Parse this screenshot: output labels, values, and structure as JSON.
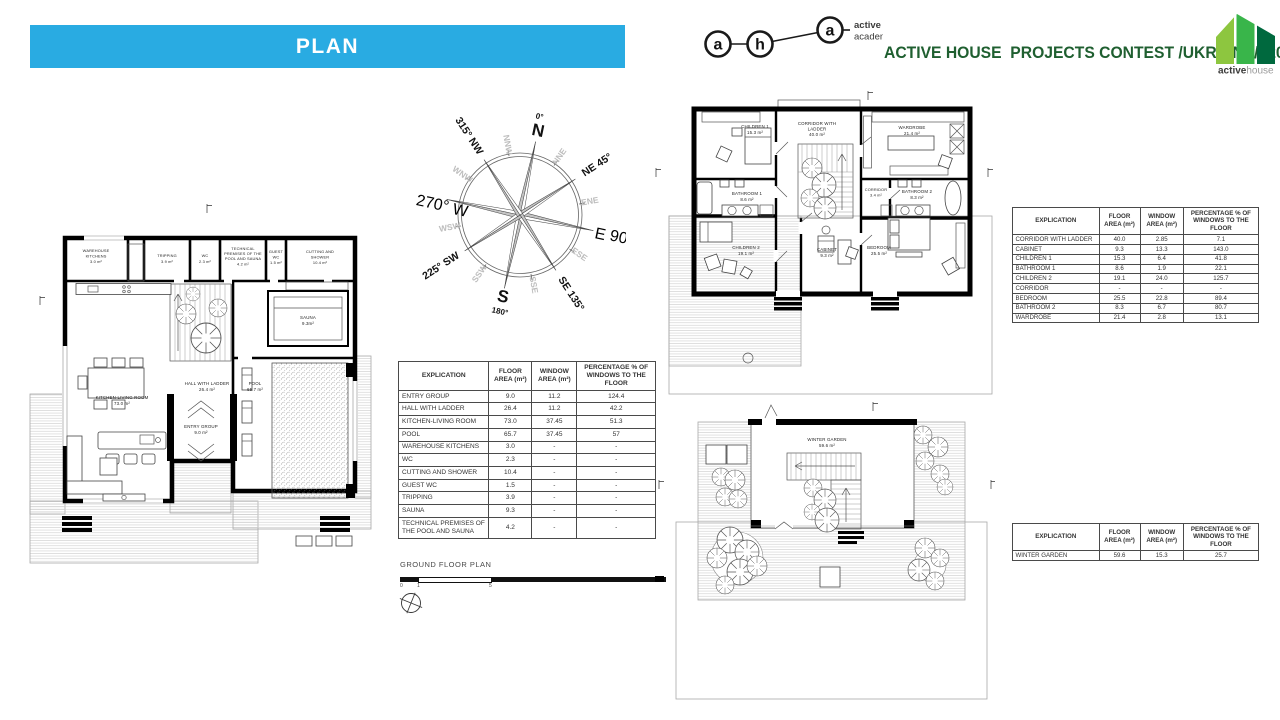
{
  "slide": {
    "section_title": "PLAN"
  },
  "branding": {
    "academy": {
      "letter1": "a",
      "letter2": "h",
      "letter3": "a",
      "line1": "active house",
      "line2": "academy"
    },
    "contest_title": "ACTIVE HOUSE  PROJECTS CONTEST /UKRAINE/  2019",
    "activehouse": {
      "bold": "active",
      "light": "house"
    },
    "colors": {
      "banner_blue": "#29ABE2",
      "title_green": "#1F5F30",
      "logo_light_green": "#8DC63F",
      "logo_mid_green": "#39B54A",
      "logo_dark_green": "#00693E"
    }
  },
  "compass": {
    "n": "N",
    "n_deg": "0°",
    "e": "E",
    "e_deg": " 90°",
    "s": "S",
    "s_deg": "180°",
    "w": "W",
    "w_deg": "270° ",
    "ne": "NE 45°",
    "se": "SE 135°",
    "sw": "225° SW",
    "nw": "315° NW",
    "secondary": [
      "NNE",
      "ENE",
      "ESE",
      "SSE",
      "SSW",
      "WSW",
      "WNW",
      "NNW"
    ]
  },
  "ground_floor": {
    "caption": "GROUND FLOOR PLAN",
    "scale": [
      "0",
      "1",
      "5"
    ],
    "rooms": {
      "warehouse": {
        "l1": "WAREHOUSE",
        "l2": "KITCHENS",
        "area": "3.0 m²"
      },
      "tripping": {
        "l1": "TRIPPING",
        "area": "3.9 m²"
      },
      "wc": {
        "l1": "WC",
        "area": "2.3 m²"
      },
      "technical": {
        "l1": "TECHNICAL",
        "l2": "PREMISES OF THE",
        "l3": "POOL AND SAUNA",
        "area": "4.2 m²"
      },
      "guest_wc": {
        "l1": "GUEST",
        "l2": "WC",
        "area": "1.5 m²"
      },
      "cutting": {
        "l1": "CUTTING AND",
        "l2": "SHOWER",
        "area": "10.4 m²"
      },
      "sauna": {
        "l1": "SAUNA",
        "area": "9.3m²"
      },
      "hall": {
        "l1": "HALL WITH LADDER",
        "area": "26.4 m²"
      },
      "pool": {
        "l1": "POOL",
        "area": "65.7 m²"
      },
      "entry": {
        "l1": "ENTRY GROUP",
        "area": "9.0 m²"
      },
      "kitchen": {
        "l1": "KITCHEN-LIVING ROOM",
        "area": "73.0 m²"
      }
    }
  },
  "first_floor": {
    "rooms": {
      "children1": {
        "l1": "CHILDREN 1",
        "area": "15.3 m²"
      },
      "corridor_ladder": {
        "l1": "CORRIDOR WITH",
        "l2": "LADDER",
        "area": "40.0 m²"
      },
      "wardrobe": {
        "l1": "WARDROBE",
        "area": "21.4 m²"
      },
      "bathroom1": {
        "l1": "BATHROOM 1",
        "area": "8.6 m²"
      },
      "corridor": {
        "l1": "CORRIDOR",
        "area": "3.4 m²"
      },
      "bathroom2": {
        "l1": "BATHROOM 2",
        "area": "8.3 m²"
      },
      "children2": {
        "l1": "CHILDREN 2",
        "area": "19.1 m²"
      },
      "cabinet": {
        "l1": "CABINET",
        "area": "9.3 m²"
      },
      "bedroom": {
        "l1": "BEDROOM",
        "area": "25.5 m²"
      }
    }
  },
  "winter_garden": {
    "rooms": {
      "winter_garden": {
        "l1": "WINTER GARDEN",
        "area": "59.6 m²"
      }
    }
  },
  "tables": {
    "ground": {
      "columns": [
        "EXPLICATION",
        "FLOOR\nAREA (m²)",
        "WINDOW\nAREA (m²)",
        "PERCENTAGE % OF\nWINDOWS TO THE FLOOR"
      ],
      "rows": [
        [
          "ENTRY GROUP",
          "9.0",
          "11.2",
          "124.4"
        ],
        [
          "HALL WITH LADDER",
          "26.4",
          "11.2",
          "42.2"
        ],
        [
          "KITCHEN-LIVING ROOM",
          "73.0",
          "37.45",
          "51.3"
        ],
        [
          "POOL",
          "65.7",
          "37.45",
          "57"
        ],
        [
          "WAREHOUSE KITCHENS",
          "3.0",
          "-",
          "-"
        ],
        [
          "WC",
          "2.3",
          "-",
          "-"
        ],
        [
          "CUTTING AND SHOWER",
          "10.4",
          "-",
          "-"
        ],
        [
          "GUEST WC",
          "1.5",
          "-",
          "-"
        ],
        [
          "TRIPPING",
          "3.9",
          "-",
          "-"
        ],
        [
          "SAUNA",
          "9.3",
          "-",
          "-"
        ],
        [
          "TECHNICAL PREMISES OF THE POOL AND SAUNA",
          "4.2",
          "-",
          "-"
        ]
      ]
    },
    "first": {
      "columns": [
        "EXPLICATION",
        "FLOOR\nAREA (m²)",
        "WINDOW\nAREA (m²)",
        "PERCENTAGE % OF\nWINDOWS TO THE FLOOR"
      ],
      "rows": [
        [
          "CORRIDOR WITH LADDER",
          "40.0",
          "2.85",
          "7.1"
        ],
        [
          "CABINET",
          "9.3",
          "13.3",
          "143.0"
        ],
        [
          "CHILDREN 1",
          "15.3",
          "6.4",
          "41.8"
        ],
        [
          "BATHROOM 1",
          "8.6",
          "1.9",
          "22.1"
        ],
        [
          "CHILDREN 2",
          "19.1",
          "24.0",
          "125.7"
        ],
        [
          "CORRIDOR",
          "-",
          "-",
          "-"
        ],
        [
          "BEDROOM",
          "25.5",
          "22.8",
          "89.4"
        ],
        [
          "BATHROOM 2",
          "8.3",
          "6.7",
          "80.7"
        ],
        [
          "WARDROBE",
          "21.4",
          "2.8",
          "13.1"
        ]
      ]
    },
    "winter": {
      "columns": [
        "EXPLICATION",
        "FLOOR\nAREA (m²)",
        "WINDOW\nAREA (m²)",
        "PERCENTAGE % OF\nWINDOWS TO THE FLOOR"
      ],
      "rows": [
        [
          "WINTER GARDEN",
          "59.6",
          "15.3",
          "25.7"
        ]
      ]
    }
  }
}
